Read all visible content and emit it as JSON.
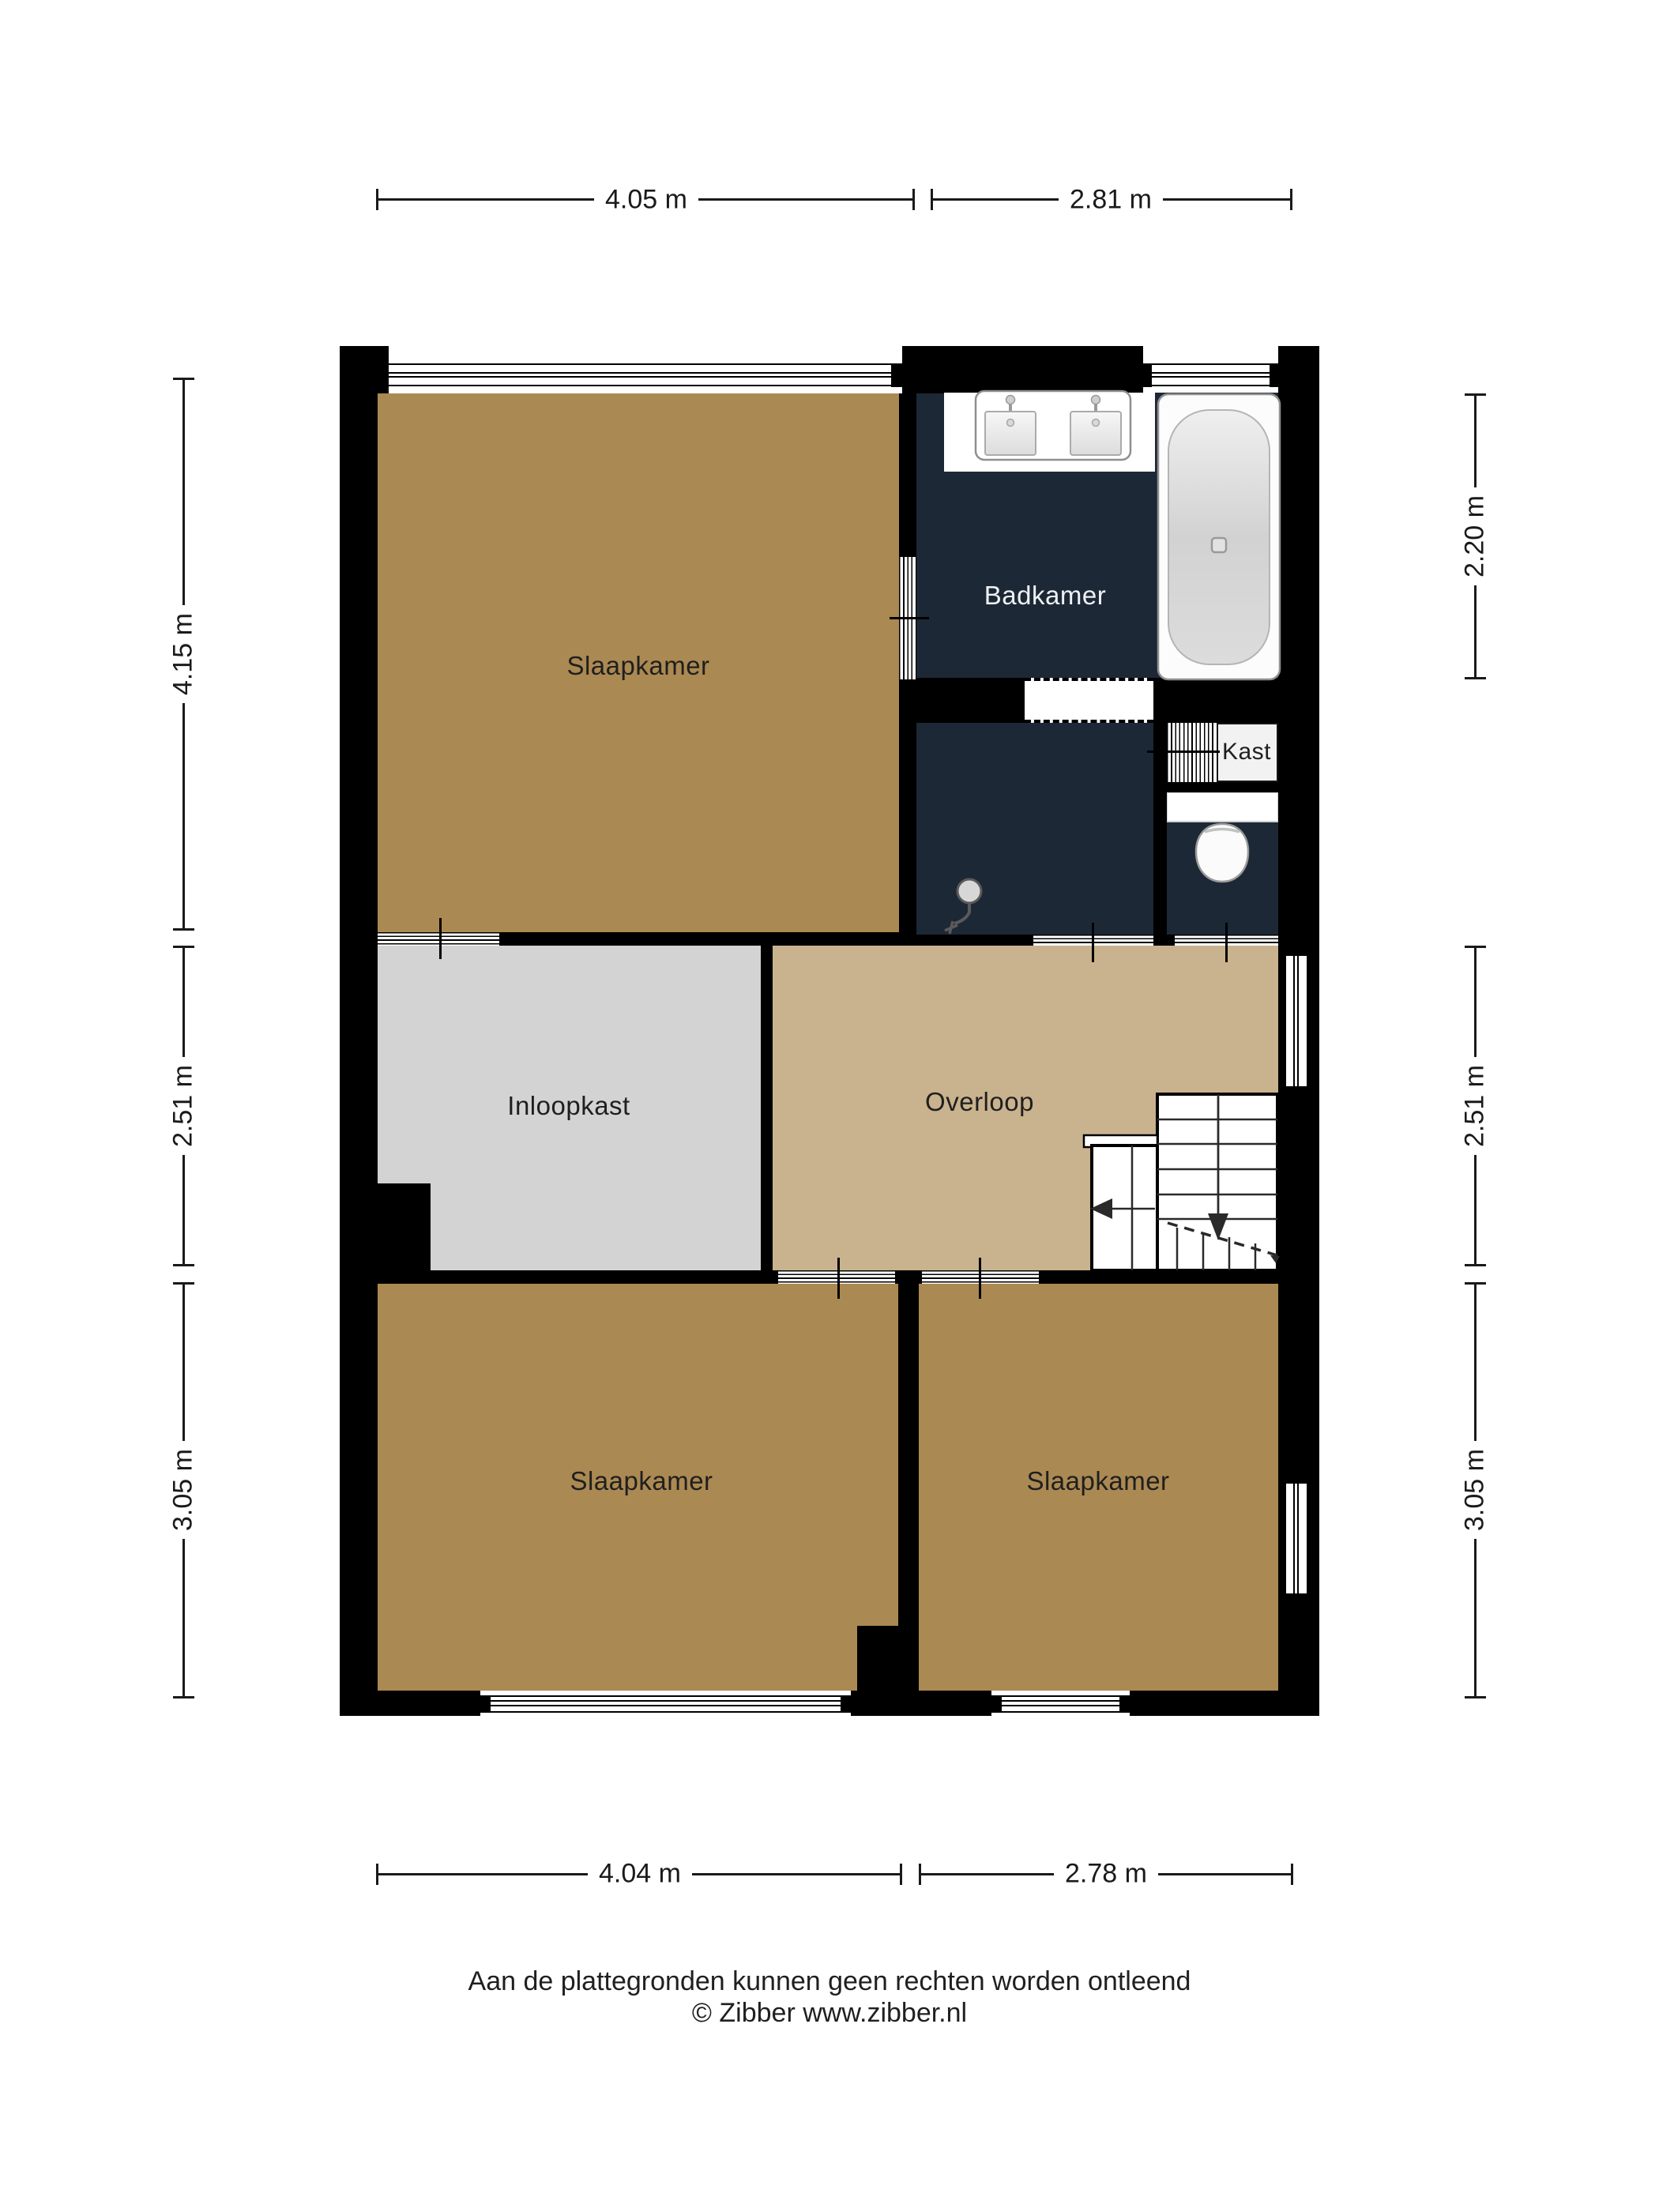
{
  "rooms": {
    "slaapkamer_top": {
      "label": "Slaapkamer"
    },
    "badkamer": {
      "label": "Badkamer"
    },
    "kast": {
      "label": "Kast"
    },
    "inloopkast": {
      "label": "Inloopkast"
    },
    "overloop": {
      "label": "Overloop"
    },
    "slaapkamer_links": {
      "label": "Slaapkamer"
    },
    "slaapkamer_rechts": {
      "label": "Slaapkamer"
    }
  },
  "dimensions": {
    "top": [
      {
        "label": "4.05 m"
      },
      {
        "label": "2.81 m"
      }
    ],
    "bottom": [
      {
        "label": "4.04 m"
      },
      {
        "label": "2.78 m"
      }
    ],
    "left": [
      {
        "label": "4.15 m"
      },
      {
        "label": "2.51 m"
      },
      {
        "label": "3.05 m"
      }
    ],
    "right": [
      {
        "label": "2.20 m"
      },
      {
        "label": "2.51 m"
      },
      {
        "label": "3.05 m"
      }
    ]
  },
  "footer": {
    "line1": "Aan de plattegronden kunnen geen rechten worden ontleend",
    "line2": "© Zibber www.zibber.nl"
  },
  "colors": {
    "room_brown": "#ab8952",
    "room_tan": "#c9b28e",
    "room_gray": "#d3d3d3",
    "room_navy": "#1d2836",
    "wall": "#000000",
    "label_dark": "#1f1f1f",
    "label_light": "#eef1f5",
    "line": "#1a1a1a"
  }
}
